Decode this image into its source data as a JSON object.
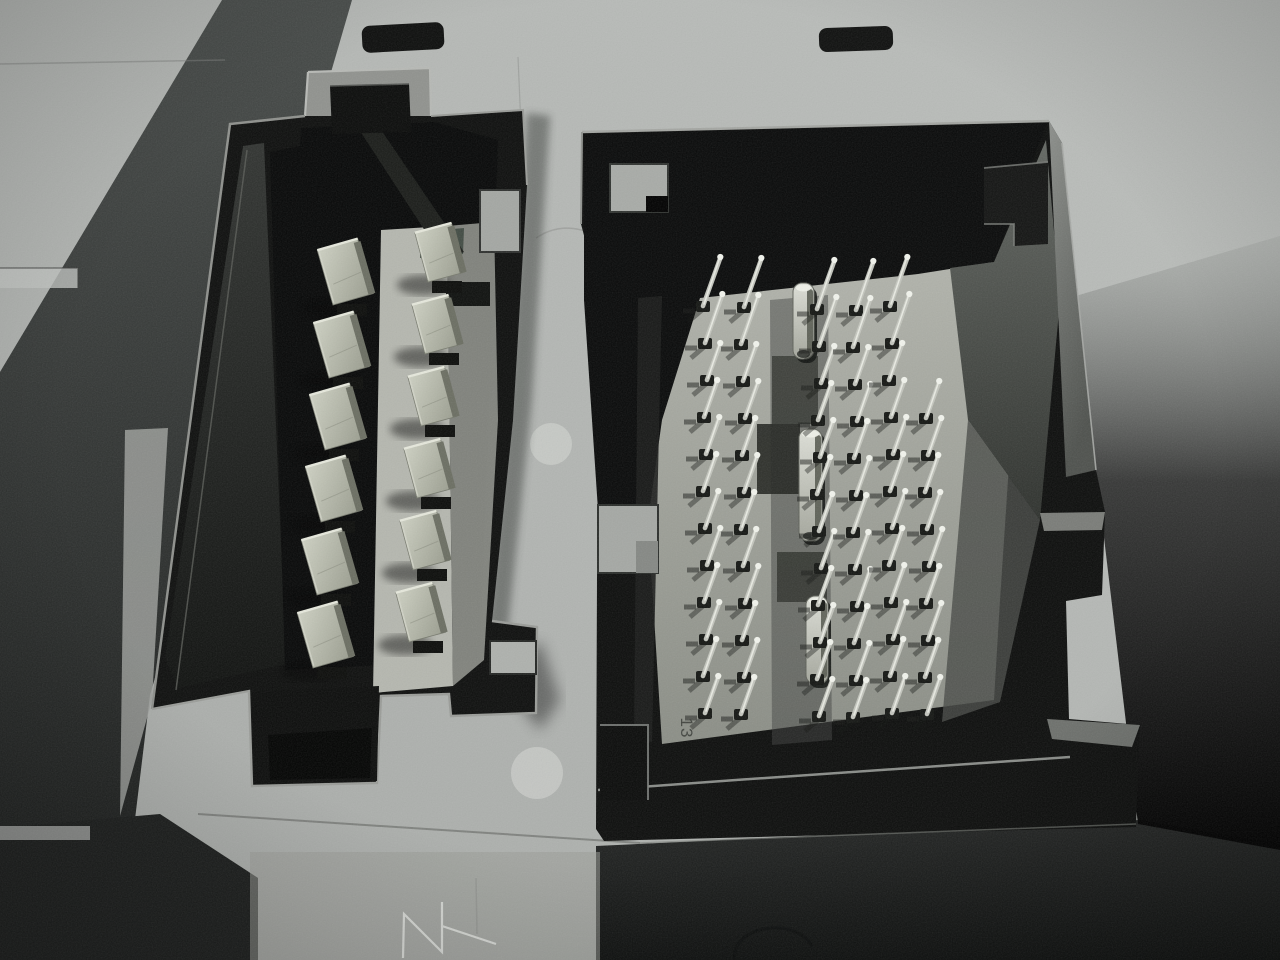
{
  "meta": {
    "title": "Macro photo of vehicle control-module connector sockets",
    "width": 1280,
    "height": 960
  },
  "scene": {
    "description": "Close-up photograph of a grey textured module housing with two black molded connector sockets: left socket holds twelve wide blade terminals in two columns; right socket holds a grid of thin square pins with three bright metal polarizing key slots; a molded number is visible near the lower-left of the right socket.",
    "background": {
      "base_color": "#b4b7b4",
      "top_left_shadow_band": "#2a2d2b",
      "bottom_dark_band": "#141615",
      "right_side_shade": "#2e312f",
      "slot_color": "#0c0d0c"
    },
    "top_slots": [
      {
        "name": "left-vent-slot",
        "x": 362,
        "y": 24,
        "w": 82,
        "h": 27
      },
      {
        "name": "right-vent-slot",
        "x": 819,
        "y": 27,
        "w": 74,
        "h": 24
      }
    ],
    "left_connector": {
      "type": "12-pin blade terminal socket",
      "frame_color": "#0d0e0d",
      "blade_color": "#b5b7a9",
      "floor_color": "#b2b4ac",
      "blade_count": 12,
      "blade_columns": [
        {
          "rotation": -16,
          "w": 42,
          "h": 57,
          "bases": [
            [
              333,
              305
            ],
            [
              329,
              378
            ],
            [
              325,
              450
            ],
            [
              321,
              522
            ],
            [
              317,
              595
            ],
            [
              313,
              668
            ]
          ]
        },
        {
          "rotation": -15,
          "w": 38,
          "h": 51,
          "bases": [
            [
              428,
              282
            ],
            [
              425,
              354
            ],
            [
              421,
              426
            ],
            [
              417,
              498
            ],
            [
              413,
              570
            ],
            [
              409,
              642
            ]
          ]
        }
      ]
    },
    "right_connector": {
      "type": "multi-pin micro terminal socket",
      "frame_color": "#0c0d0c",
      "floor_color": "#a8aaa2",
      "pin_color": "#c3c5bd",
      "molded_label": "13",
      "pin_grid": {
        "row0_y": 308,
        "row_pitch": 37,
        "row_count": 12,
        "stem_len": 36,
        "tall_len": 48,
        "groups": [
          {
            "cols": [
              706,
              744
            ],
            "tall_rows": 2
          },
          {
            "cols": [
              820,
              856,
              892
            ],
            "tall_rows": 2
          },
          {
            "cols": [
              928
            ],
            "row_start": 3
          }
        ]
      },
      "keys": [
        {
          "x": 793,
          "y": 283,
          "w": 21,
          "h": 76
        },
        {
          "x": 799,
          "y": 429,
          "w": 23,
          "h": 112
        },
        {
          "x": 806,
          "y": 596,
          "w": 22,
          "h": 88
        }
      ],
      "dark_blocks": [
        {
          "x": 772,
          "y": 356,
          "w": 46,
          "h": 68,
          "color": "#2d302b",
          "opacity": 0.75
        },
        {
          "x": 757,
          "y": 424,
          "w": 43,
          "h": 70,
          "color": "#222520",
          "opacity": 0.9
        },
        {
          "x": 777,
          "y": 552,
          "w": 50,
          "h": 50,
          "color": "#282b26",
          "opacity": 0.75
        }
      ]
    }
  }
}
